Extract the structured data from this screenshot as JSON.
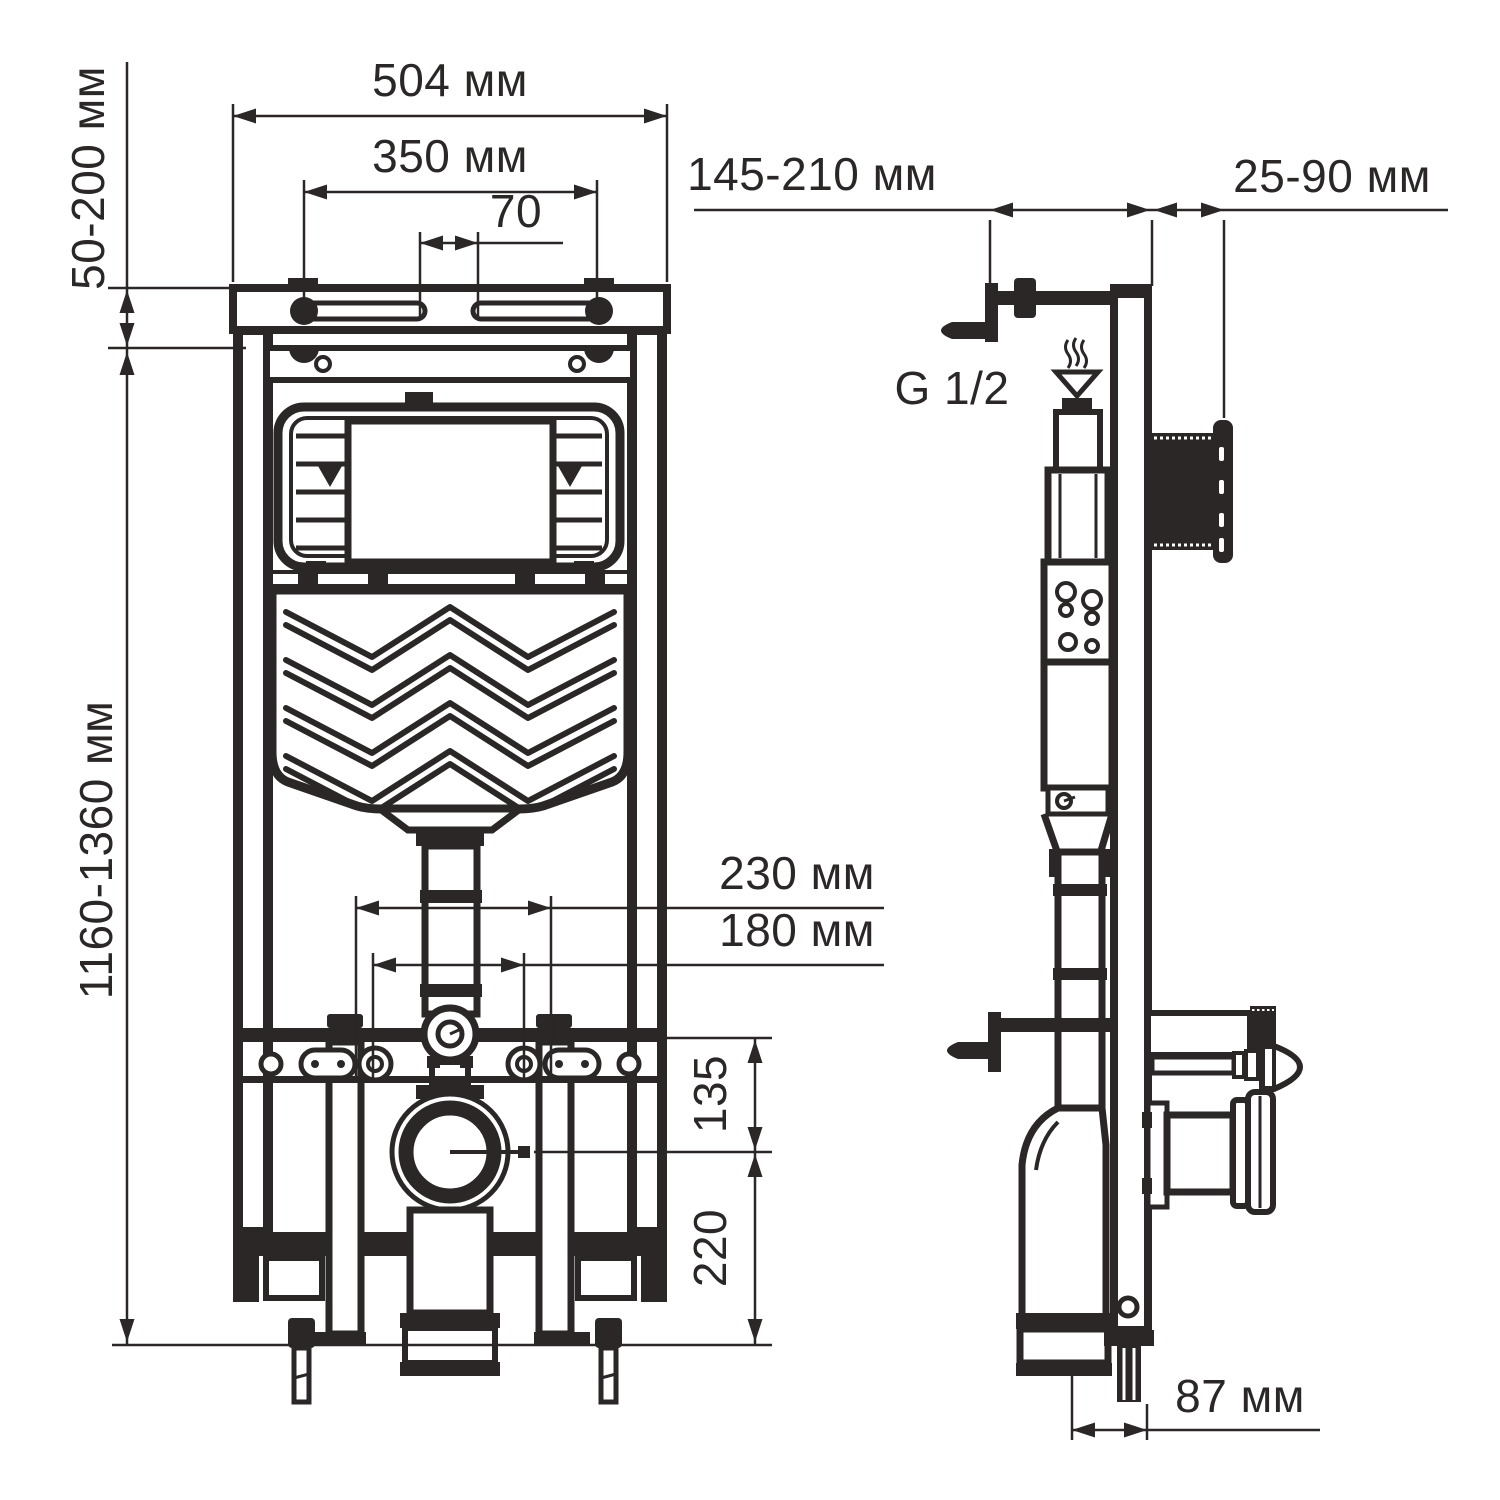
{
  "colors": {
    "ink": "#2a2726",
    "background": "#ffffff"
  },
  "dimensions": {
    "width_top": "504 мм",
    "mounting_holes_spacing": "350 мм",
    "slot_gap": "70",
    "upper_bracket_adjust": "50-200 мм",
    "frame_height": "1160-1360 мм",
    "bracket_depth": "145-210 мм",
    "button_depth": "25-90 мм",
    "water_thread": "G 1/2",
    "stud_spacing_outer": "230 мм",
    "stud_spacing_inner": "180 мм",
    "outlet_height_offset": "135",
    "outlet_floor_offset": "220",
    "drain_horizontal_offset": "87 мм"
  }
}
